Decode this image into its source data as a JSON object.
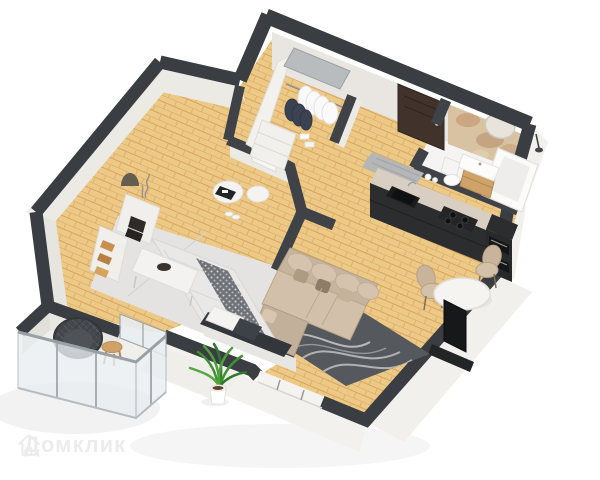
{
  "canvas": {
    "width": 600,
    "height": 480,
    "background": "#ffffff"
  },
  "watermark": {
    "text": "Домклик",
    "icon": "house-logo-icon"
  },
  "colors": {
    "wall_top": "#3a3d41",
    "wall_inner": "#3f4246",
    "wall_face": "#e9e6e1",
    "face_white": "#f2f0ec",
    "parquet_base": "#ecc986",
    "parquet_line": "#d7a45e",
    "bedroom_rug": "#e4e3e1",
    "balcony_floor": "#f0efec",
    "bath_floor": "#f5f4f2",
    "marble_wall": "#d8c2a2",
    "entry_door": "#41332b",
    "kitchen_dark": "#2c2d2f",
    "counter_top": "#d8cfc2",
    "sofa_base": "#c7b49e",
    "sofa_cushion": "#d2c0aa",
    "rug_dark": "#55585d",
    "rug_swirl": "#d8d9da",
    "bed_linen": "#e9e8e6",
    "bed_runner": "#6f7378",
    "headboard": "#33373c",
    "lounge_chair": "#45484d",
    "wood": "#cfa26a",
    "plant_green": "#3f8f35",
    "glass": "#e9eef1",
    "metal": "#b8bcbe",
    "doormat": "#b4b6b7",
    "table_white": "#f5f4f1",
    "chair_beige": "#c9b49b"
  }
}
